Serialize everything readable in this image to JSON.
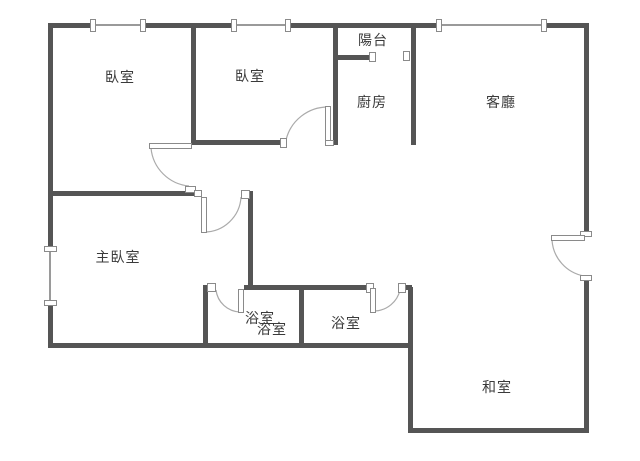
{
  "plan_title": "apartment floor plan",
  "rooms": [
    {
      "id": "bedroom-1",
      "label": "臥室"
    },
    {
      "id": "bedroom-2",
      "label": "臥室"
    },
    {
      "id": "balcony",
      "label": "陽台"
    },
    {
      "id": "kitchen",
      "label": "廚房"
    },
    {
      "id": "living-room",
      "label": "客廳"
    },
    {
      "id": "master-bedroom",
      "label": "主臥室"
    },
    {
      "id": "bathroom-1",
      "label": "浴室"
    },
    {
      "id": "bathroom-1-overlap",
      "label": "浴室"
    },
    {
      "id": "bathroom-2",
      "label": "浴室"
    },
    {
      "id": "tatami-room",
      "label": "和室"
    }
  ],
  "colors": {
    "wall": "#555555",
    "thin_line": "#9a9a9a",
    "door_arc": "#aaaaaa",
    "text": "#3a3a3a",
    "background": "#ffffff"
  }
}
